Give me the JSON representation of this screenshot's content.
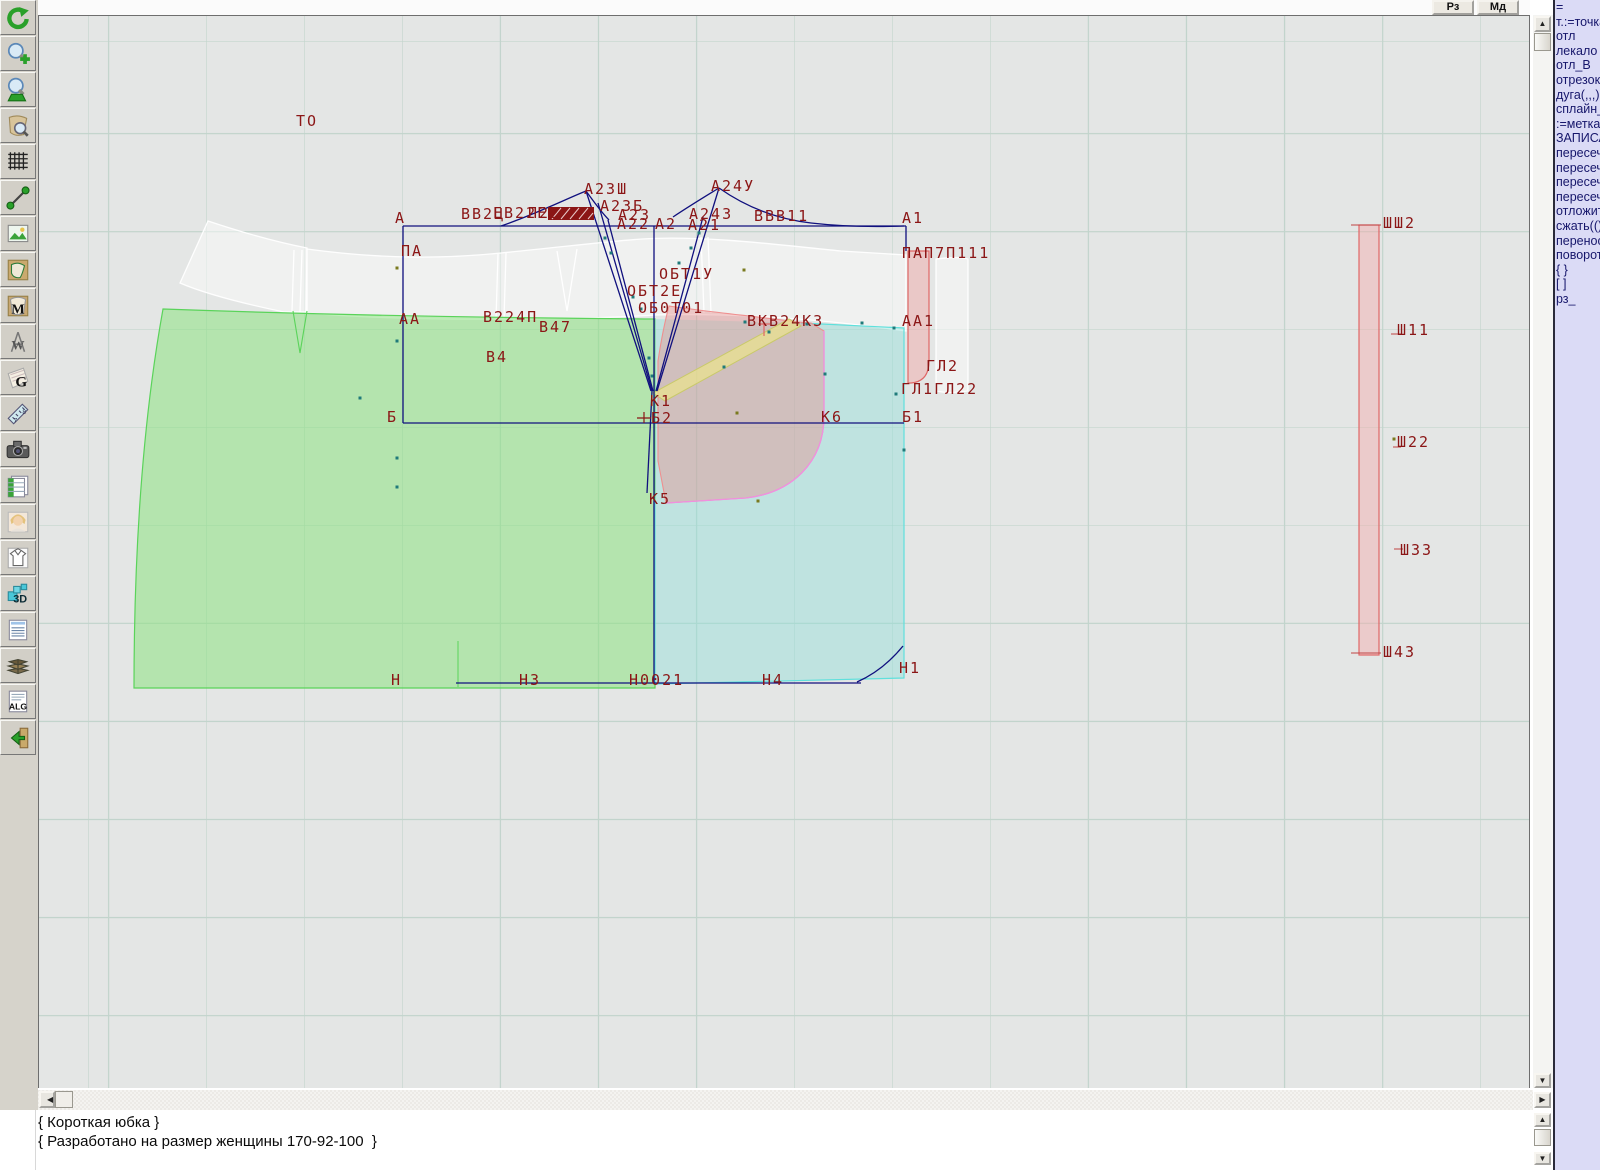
{
  "window": {
    "rz_button": "Рз",
    "md_button": "Мд"
  },
  "toolbar": {
    "items": [
      {
        "name": "refresh"
      },
      {
        "name": "zoom-in"
      },
      {
        "name": "zoom-out"
      },
      {
        "name": "zoom-piece"
      },
      {
        "name": "grid"
      },
      {
        "name": "segment"
      },
      {
        "name": "image"
      },
      {
        "name": "pattern-piece"
      },
      {
        "name": "pattern-m"
      },
      {
        "name": "compass-w"
      },
      {
        "name": "fabric-g"
      },
      {
        "name": "ruler"
      },
      {
        "name": "camera"
      },
      {
        "name": "table"
      },
      {
        "name": "portrait"
      },
      {
        "name": "garment"
      },
      {
        "name": "threed"
      },
      {
        "name": "doc-list"
      },
      {
        "name": "books"
      },
      {
        "name": "alg"
      },
      {
        "name": "exit"
      }
    ]
  },
  "right_panel": {
    "lines": [
      "=",
      "т.:=точка",
      "отл",
      "лекало",
      "отл_В",
      "отрезок",
      "дуга(,,,)",
      "сплайн_",
      ":=метка",
      "ЗАПИСА",
      "пересеч",
      "пересеч",
      "пересеч",
      "пересеч",
      "отложит",
      "сжать(()",
      "перенос",
      "поворот",
      "{ }",
      "[ ]",
      "рз_"
    ]
  },
  "status": {
    "lines": [
      "{ Короткая юбка }",
      "{ Разработано на размер женщины 170-92-100  }"
    ]
  },
  "canvas": {
    "labels": [
      {
        "t": "ТО",
        "x": 295,
        "y": 125
      },
      {
        "t": "А",
        "x": 394,
        "y": 222
      },
      {
        "t": "ПА",
        "x": 400,
        "y": 255
      },
      {
        "t": "АА",
        "x": 398,
        "y": 323
      },
      {
        "t": "Б",
        "x": 386,
        "y": 421
      },
      {
        "t": "Н",
        "x": 390,
        "y": 684
      },
      {
        "t": "Н3",
        "x": 518,
        "y": 684
      },
      {
        "t": "Н0021",
        "x": 628,
        "y": 684
      },
      {
        "t": "Н4",
        "x": 761,
        "y": 684
      },
      {
        "t": "Н1",
        "x": 898,
        "y": 672
      },
      {
        "t": "ВВ2Ц",
        "x": 460,
        "y": 218
      },
      {
        "t": "ЕВ22Е",
        "x": 492,
        "y": 217
      },
      {
        "t": "П22",
        "x": 527,
        "y": 217
      },
      {
        "t": "А23Ш",
        "x": 583,
        "y": 193
      },
      {
        "t": "А23Б",
        "x": 599,
        "y": 210
      },
      {
        "t": "А23",
        "x": 617,
        "y": 219
      },
      {
        "t": "А22",
        "x": 616,
        "y": 228
      },
      {
        "t": "А2",
        "x": 654,
        "y": 228
      },
      {
        "t": "А24У",
        "x": 710,
        "y": 190
      },
      {
        "t": "А243",
        "x": 688,
        "y": 218
      },
      {
        "t": "А21",
        "x": 687,
        "y": 229
      },
      {
        "t": "ВВВ11",
        "x": 753,
        "y": 220
      },
      {
        "t": "А1",
        "x": 901,
        "y": 222
      },
      {
        "t": "ПАП7П111",
        "x": 901,
        "y": 257
      },
      {
        "t": "ОБТ1У",
        "x": 658,
        "y": 278
      },
      {
        "t": "ОБТ2Е",
        "x": 626,
        "y": 295
      },
      {
        "t": "ОБ0Т01",
        "x": 637,
        "y": 312
      },
      {
        "t": "В224П",
        "x": 482,
        "y": 321
      },
      {
        "t": "В47",
        "x": 538,
        "y": 331
      },
      {
        "t": "В4",
        "x": 485,
        "y": 361
      },
      {
        "t": "АА1",
        "x": 901,
        "y": 325
      },
      {
        "t": "ВКВ24К3",
        "x": 746,
        "y": 325
      },
      {
        "t": "ГЛ2",
        "x": 925,
        "y": 370
      },
      {
        "t": "ГЛ1ГЛ22",
        "x": 900,
        "y": 393
      },
      {
        "t": "К1",
        "x": 649,
        "y": 405
      },
      {
        "t": "Б2",
        "x": 650,
        "y": 422
      },
      {
        "t": "К6",
        "x": 820,
        "y": 421
      },
      {
        "t": "Б1",
        "x": 901,
        "y": 421
      },
      {
        "t": "К5",
        "x": 648,
        "y": 503
      },
      {
        "t": "ШШ2",
        "x": 1382,
        "y": 227
      },
      {
        "t": "Ш11",
        "x": 1396,
        "y": 334
      },
      {
        "t": "Ш22",
        "x": 1396,
        "y": 446
      },
      {
        "t": "Ш33",
        "x": 1399,
        "y": 554
      },
      {
        "t": "Ш43",
        "x": 1382,
        "y": 656
      }
    ],
    "dots": [
      {
        "x": 396,
        "y": 267,
        "c": "olive"
      },
      {
        "x": 743,
        "y": 269,
        "c": "olive"
      },
      {
        "x": 736,
        "y": 412,
        "c": "olive"
      },
      {
        "x": 757,
        "y": 500,
        "c": "olive"
      },
      {
        "x": 1393,
        "y": 438,
        "c": "olive"
      },
      {
        "x": 396,
        "y": 340,
        "c": "teal"
      },
      {
        "x": 396,
        "y": 457,
        "c": "teal"
      },
      {
        "x": 396,
        "y": 486,
        "c": "teal"
      },
      {
        "x": 359,
        "y": 397,
        "c": "teal"
      },
      {
        "x": 604,
        "y": 237,
        "c": "teal"
      },
      {
        "x": 610,
        "y": 252,
        "c": "teal"
      },
      {
        "x": 632,
        "y": 296,
        "c": "teal"
      },
      {
        "x": 640,
        "y": 308,
        "c": "teal"
      },
      {
        "x": 678,
        "y": 262,
        "c": "teal"
      },
      {
        "x": 690,
        "y": 247,
        "c": "teal"
      },
      {
        "x": 698,
        "y": 232,
        "c": "teal"
      },
      {
        "x": 768,
        "y": 331,
        "c": "teal"
      },
      {
        "x": 723,
        "y": 366,
        "c": "teal"
      },
      {
        "x": 806,
        "y": 323,
        "c": "teal"
      },
      {
        "x": 744,
        "y": 321,
        "c": "teal"
      },
      {
        "x": 893,
        "y": 327,
        "c": "teal"
      },
      {
        "x": 895,
        "y": 393,
        "c": "teal"
      },
      {
        "x": 903,
        "y": 449,
        "c": "teal"
      },
      {
        "x": 648,
        "y": 357,
        "c": "teal"
      },
      {
        "x": 651,
        "y": 375,
        "c": "teal"
      },
      {
        "x": 824,
        "y": 373,
        "c": "teal"
      },
      {
        "x": 861,
        "y": 322,
        "c": "teal"
      }
    ],
    "colors": {
      "label": "#8b1616",
      "navy": "#10107e",
      "teal_dot": "#1f7a7a",
      "olive_dot": "#7a7a1f",
      "green_fill": "rgba(140,225,130,0.55)",
      "cyan_fill": "rgba(140,225,218,0.42)",
      "pink_fill": "rgba(230,140,140,0.42)",
      "yellow_fill": "rgba(240,235,130,0.6)"
    }
  }
}
